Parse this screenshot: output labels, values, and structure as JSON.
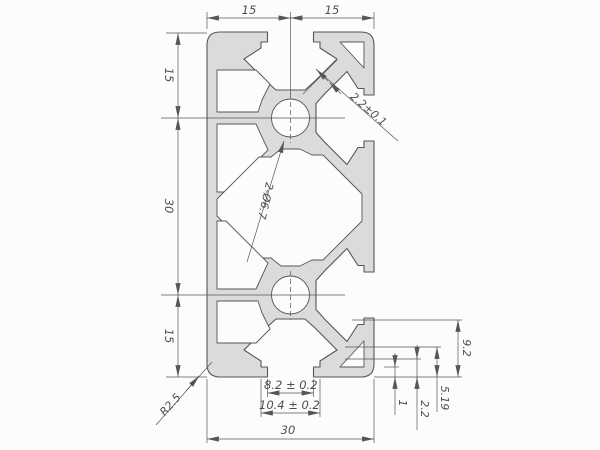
{
  "drawing": {
    "colors": {
      "background": "#fcfcfc",
      "profile_fill": "#dbdbdb",
      "line": "#565656",
      "text": "#4f4f4f"
    },
    "dimensions": {
      "top": [
        "15",
        "15"
      ],
      "left": [
        "15",
        "30",
        "15"
      ],
      "bottom": {
        "slot_opening": "8.2 ± 0.2",
        "slot_undercut": "10.4 ± 0.2",
        "overall_width": "30"
      },
      "right": {
        "d1": "9.2",
        "d2": "5.19",
        "d3": "2.2",
        "d4": "1"
      },
      "leaders": {
        "slot_wall_thickness": "2.2±0.1",
        "holes": "2-Ø6.7",
        "corner_radius": "R2.5"
      }
    }
  }
}
